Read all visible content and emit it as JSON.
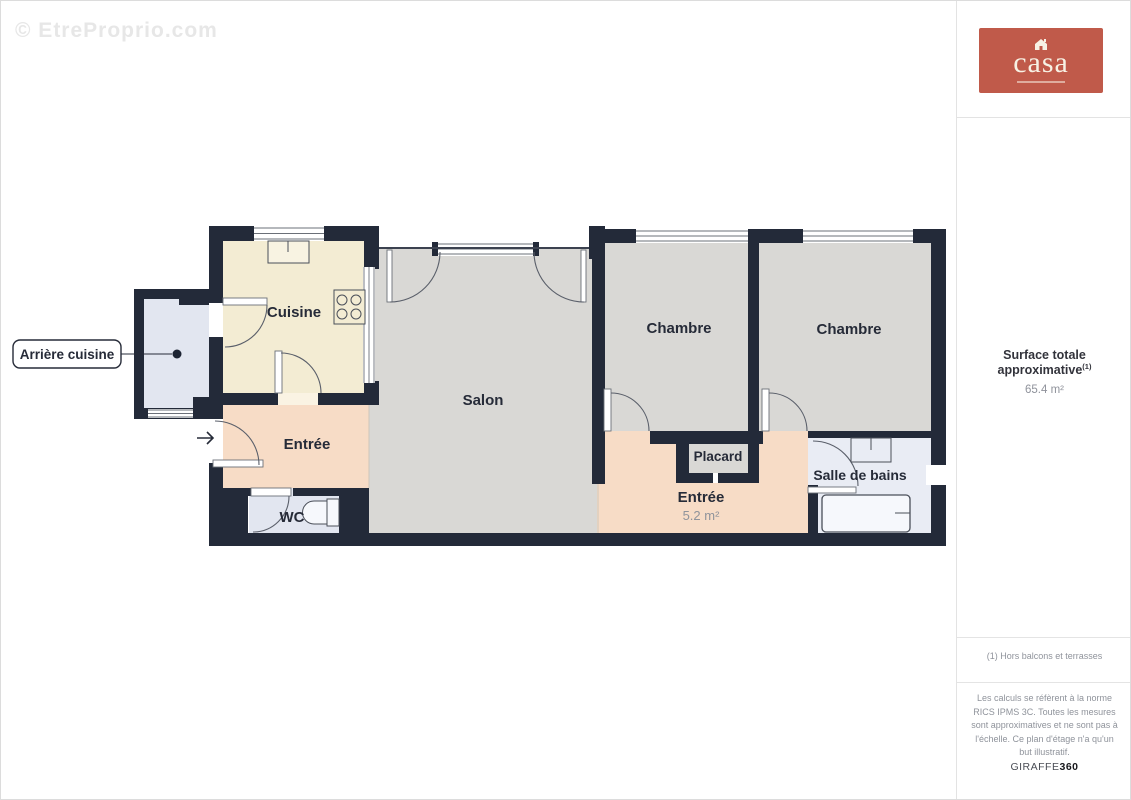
{
  "watermark": "© EtreProprio.com",
  "logo": {
    "text": "casa",
    "bg_color": "#c05a4a",
    "text_color": "#f7f1e4"
  },
  "panel": {
    "surface_label": "Surface totale approximative",
    "surface_sup": "(1)",
    "surface_value": "65.4 m²",
    "footnote": "(1) Hors balcons et terrasses",
    "disclaimer": "Les calculs se réfèrent à la norme RICS IPMS 3C. Toutes les mesures sont approximatives et ne sont pas à l'échelle. Ce plan d'étage n'a qu'un but illustratif.",
    "brand_name": "GIRAFFE",
    "brand_suffix": "360"
  },
  "floorplan": {
    "labels": {
      "arriere_cuisine": "Arrière cuisine",
      "cuisine": "Cuisine",
      "entree_left": "Entrée",
      "wc": "WC",
      "salon": "Salon",
      "chambre_1": "Chambre",
      "chambre_2": "Chambre",
      "placard": "Placard",
      "entree_right": "Entrée",
      "entree_right_area": "5.2 m²",
      "salle_de_bains": "Salle de bains"
    },
    "colors": {
      "wall": "#232a39",
      "kitchen_floor": "#f3ecd3",
      "living_floor": "#d9d8d5",
      "hall_floor": "#f7dcc6",
      "utility_floor": "#e2e6f0",
      "bath_floor": "#e9ecf4"
    }
  }
}
